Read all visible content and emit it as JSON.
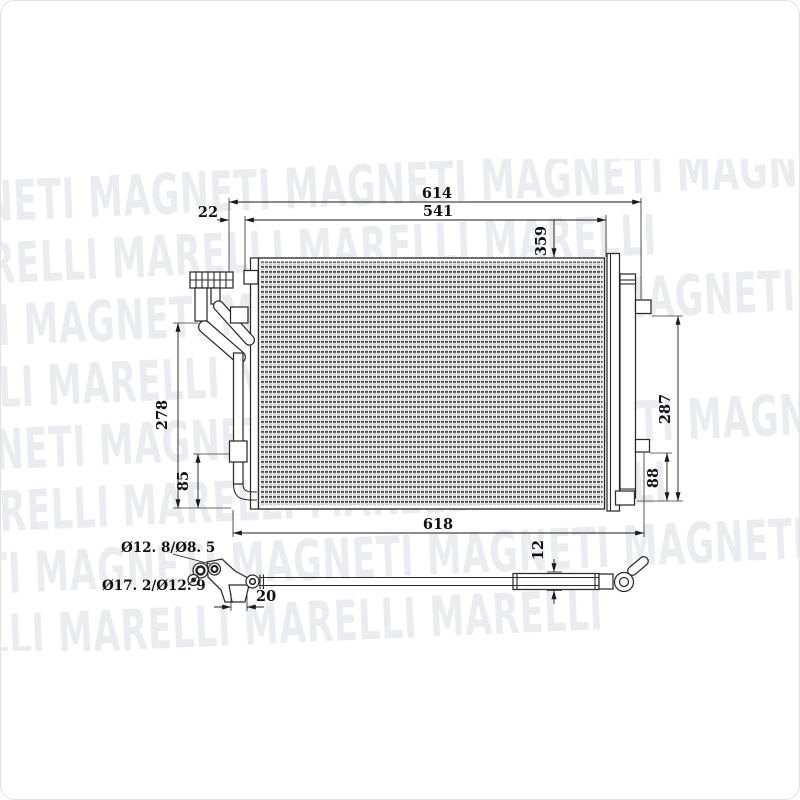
{
  "watermark": {
    "brand": "MAGNETI MARELLI",
    "rows": [
      "MAGNETI MAGNETI MAGNETI MAGNETI MAGNETI",
      "MARELLI MARELLI MARELLI MARELLI MARELLI",
      "MAGNETI MAGNETI MAGNETI MAGNETI MAGNETI",
      "MARELLI MARELLI MARELLI MARELLI MARELLI",
      "MAGNETI MAGNETI MAGNETI MAGNETI MAGNETI",
      "MARELLI MARELLI MARELLI MARELLI MARELLI",
      "MAGNETI MAGNETI MAGNETI MAGNETI MAGNETI",
      "MARELLI MARELLI MARELLI MARELLI MARELLI"
    ]
  },
  "dims": {
    "d614": "614",
    "d541": "541",
    "d22": "22",
    "d359": "359",
    "d278": "278",
    "d85": "85",
    "d287": "287",
    "d88": "88",
    "d618": "618",
    "d12": "12",
    "d20": "20",
    "dia_top": "Ø12. 8/Ø8. 5",
    "dia_bottom": "Ø17. 2/Ø12. 9"
  }
}
